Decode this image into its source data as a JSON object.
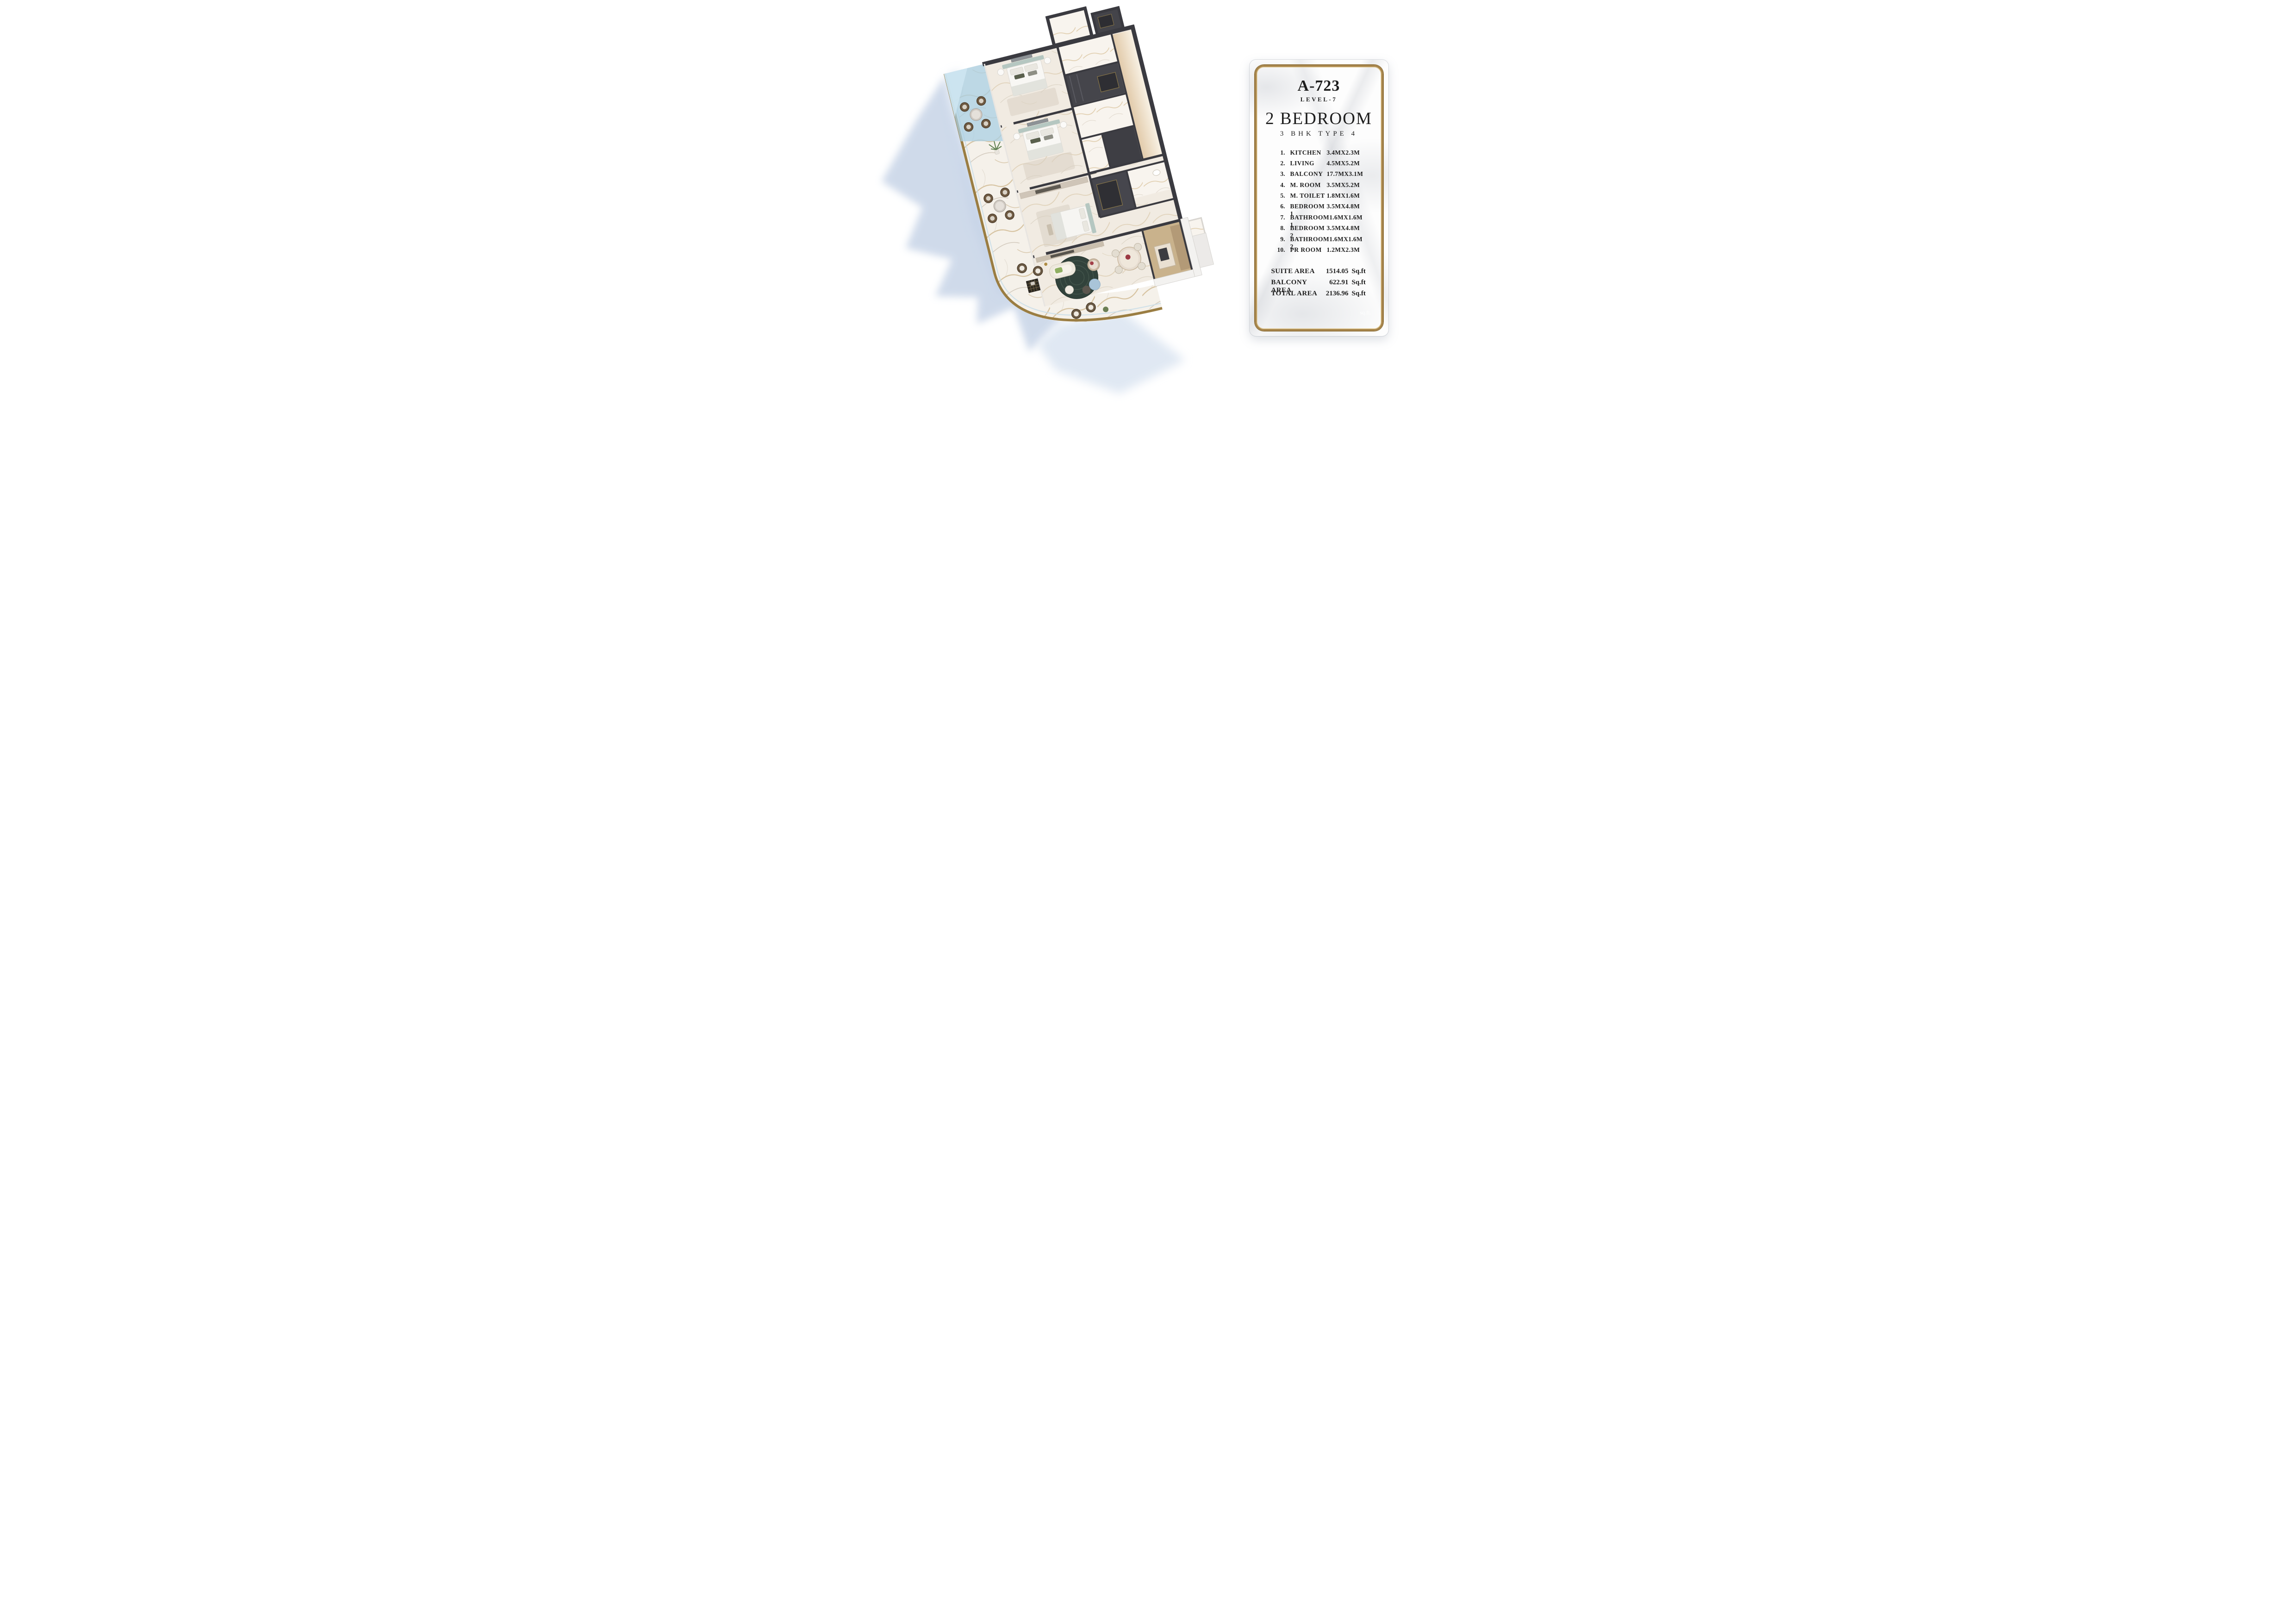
{
  "card": {
    "unit_code": "A-723",
    "level": "LEVEL-7",
    "type_title": "2 BEDROOM",
    "type_subtitle": "3 BHK TYPE 4",
    "rooms": [
      {
        "num": "1.",
        "name": "KITCHEN",
        "dim": "3.4MX2.3M"
      },
      {
        "num": "2.",
        "name": "LIVING",
        "dim": "4.5MX5.2M"
      },
      {
        "num": "3.",
        "name": "BALCONY",
        "dim": "17.7MX3.1M"
      },
      {
        "num": "4.",
        "name": "M. ROOM",
        "dim": "3.5MX5.2M"
      },
      {
        "num": "5.",
        "name": "M. TOILET",
        "dim": "1.8MX1.6M"
      },
      {
        "num": "6.",
        "name": "BEDROOM 1",
        "dim": "3.5MX4.8M"
      },
      {
        "num": "7.",
        "name": "BATHROOM 1",
        "dim": "1.6MX1.6M"
      },
      {
        "num": "8.",
        "name": "BEDROOM 2",
        "dim": "3.5MX4.8M"
      },
      {
        "num": "9.",
        "name": "BATHROOM 2",
        "dim": "1.6MX1.6M"
      },
      {
        "num": "10.",
        "name": "PR ROOM",
        "dim": "1.2MX2.3M"
      }
    ],
    "areas": [
      {
        "label": "SUITE AREA",
        "value": "1514.05",
        "unit": "Sq.ft"
      },
      {
        "label": "BALCONY AREA",
        "value": "622.91",
        "unit": "Sq.ft"
      },
      {
        "label": "TOTAL AREA",
        "value": "2136.96",
        "unit": "Sq.ft"
      }
    ],
    "watermark": "sq.ft.",
    "colors": {
      "gold_frame": "#a5834a",
      "text": "#1d1d1d",
      "marble_bg": "#fdfdfd"
    }
  },
  "plan": {
    "colors": {
      "dark_wall": "#3a3a40",
      "marble_floor": "#f1ebe2",
      "balcony_marble": "#f5f1ea",
      "glass_blue": "#a9cfe3",
      "gold_trim": "#9a7d42",
      "cast_shadow": "#c7d4e7",
      "rug_teal": "#31423b",
      "headboard_sage": "#b5c7c1",
      "wood_kitchen": "#c9b28c"
    }
  }
}
